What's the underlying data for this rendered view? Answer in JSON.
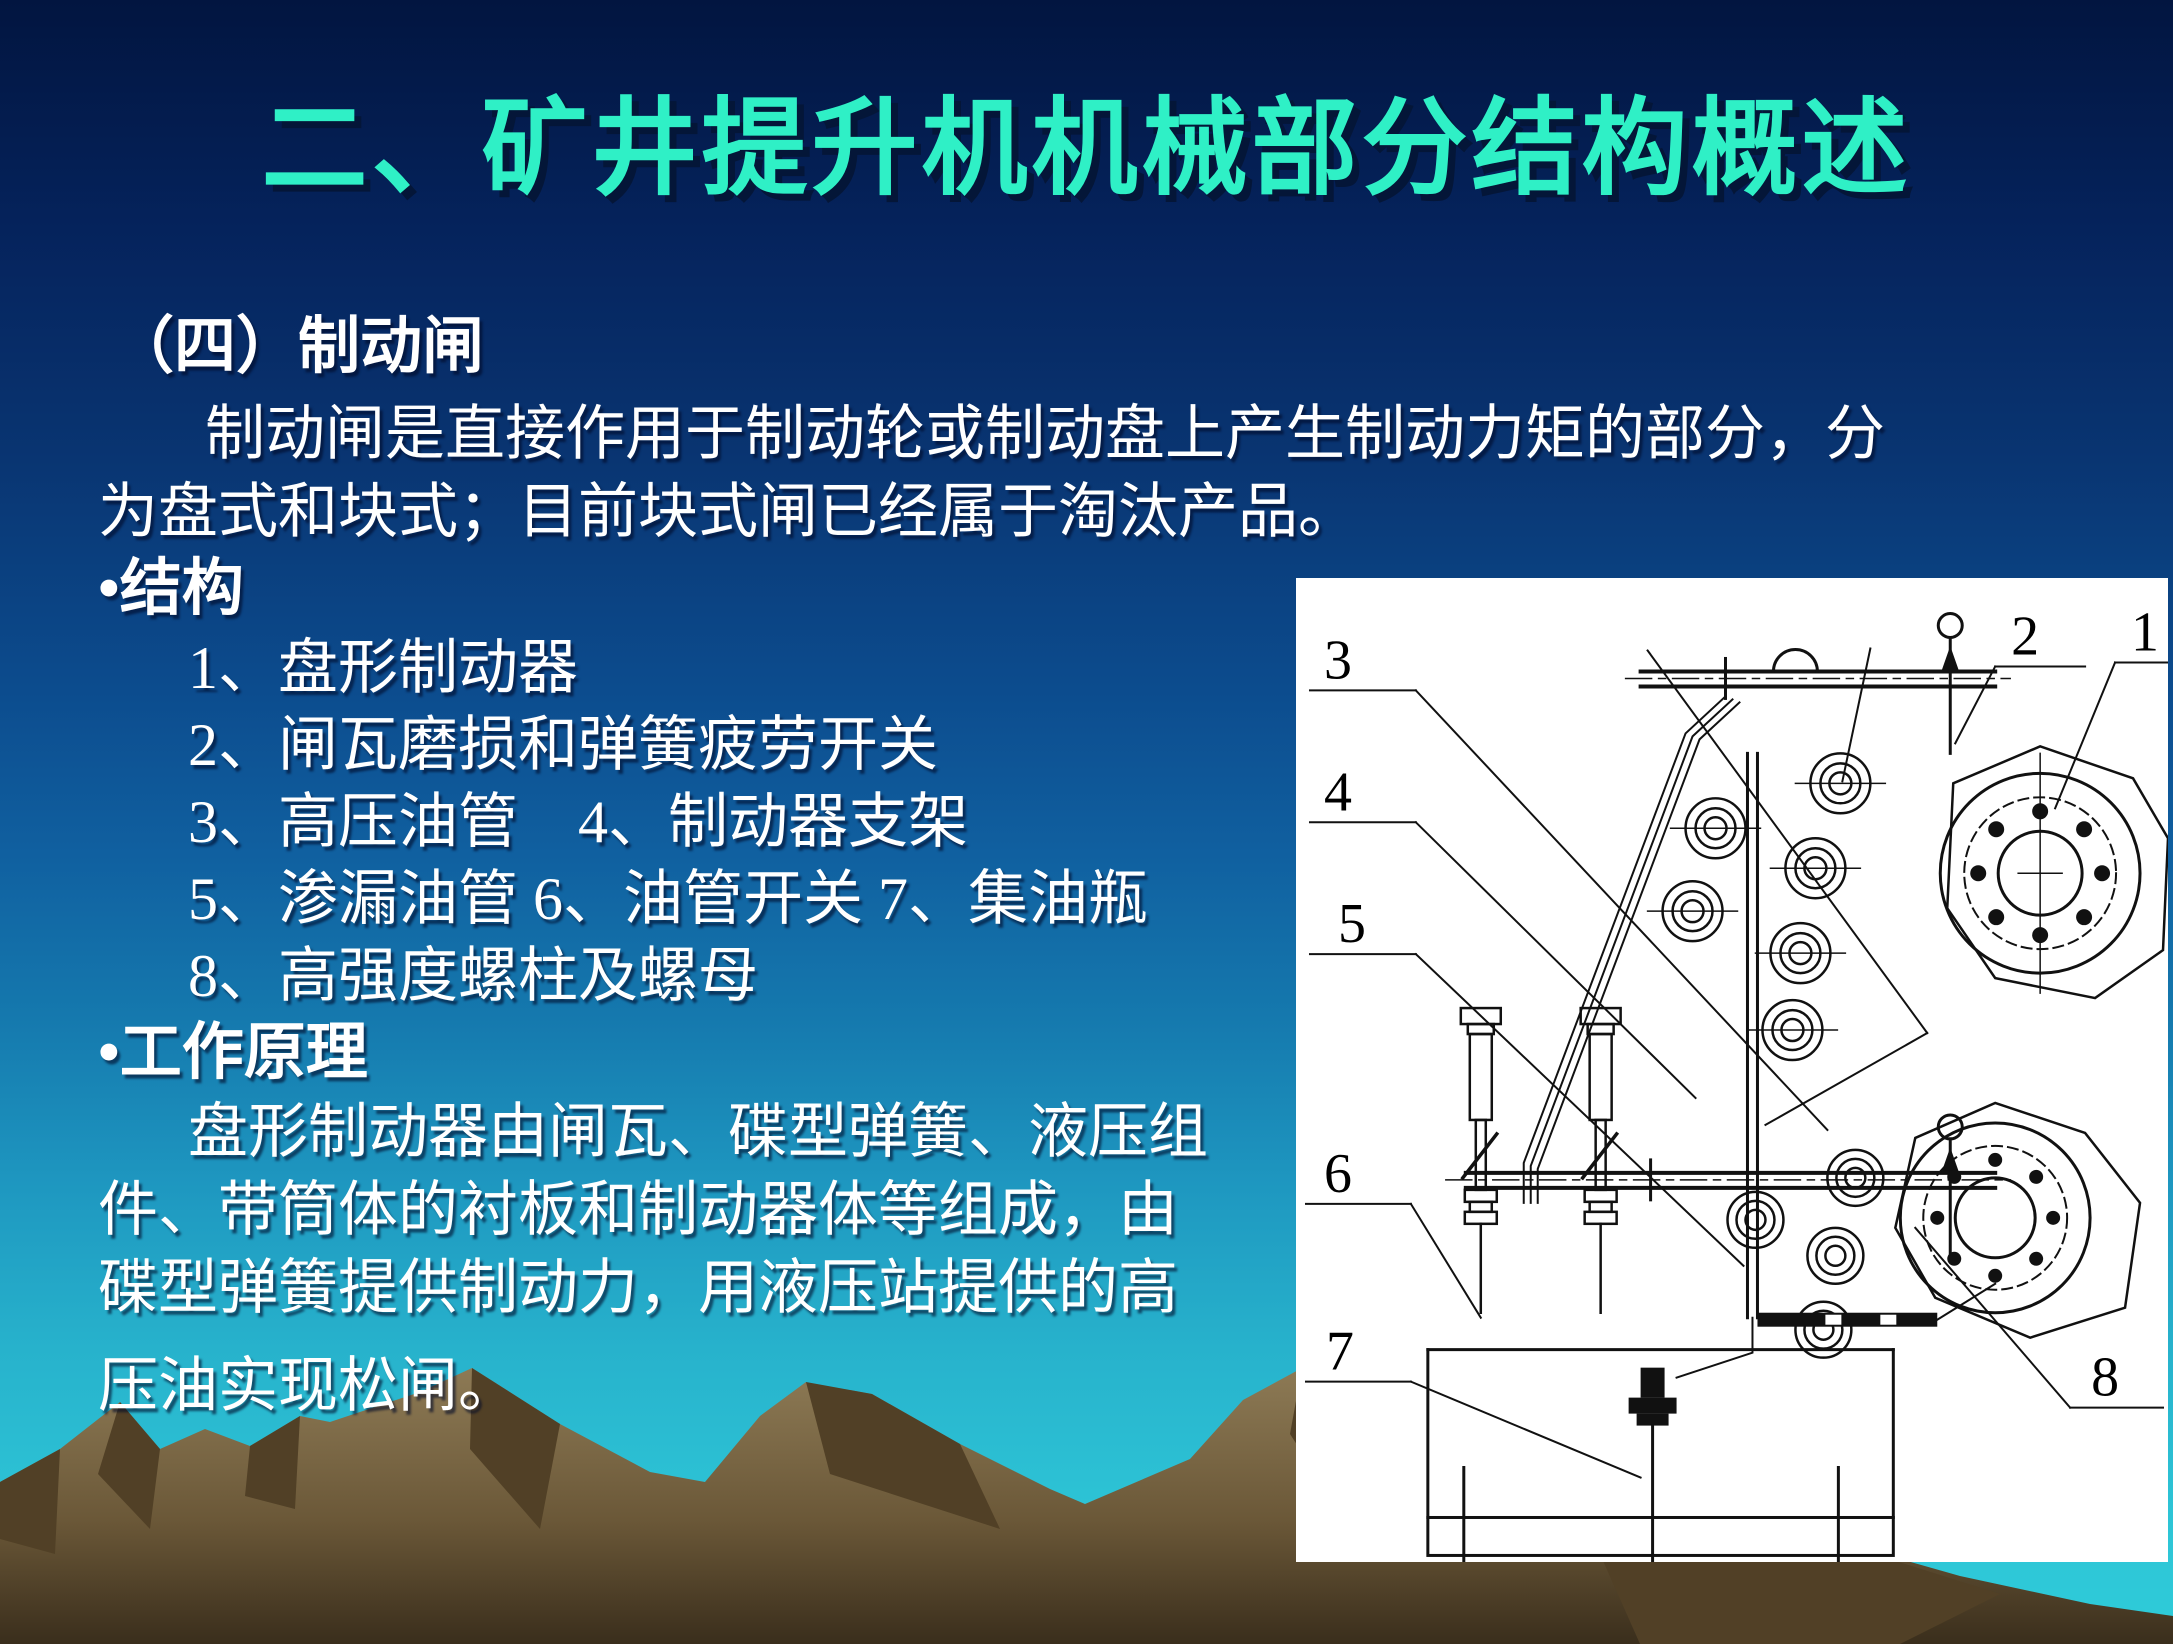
{
  "title": "二、矿井提升机机械部分结构概述",
  "section": {
    "heading": "（四）制动闸"
  },
  "intro": {
    "line1": "制动闸是直接作用于制动轮或制动盘上产生制动力矩的部分，分",
    "line2": "为盘式和块式；目前块式闸已经属于淘汰产品。"
  },
  "structure": {
    "heading": "•结构",
    "items": [
      "1、盘形制动器",
      "2、闸瓦磨损和弹簧疲劳开关",
      "3、高压油管　4、制动器支架",
      "5、渗漏油管 6、油管开关 7、集油瓶",
      "8、高强度螺柱及螺母"
    ]
  },
  "principle": {
    "heading": "•工作原理",
    "lines": [
      "盘形制动器由闸瓦、碟型弹簧、液压组",
      "件、带筒体的衬板和制动器体等组成，由",
      "碟型弹簧提供制动力，用液压站提供的高",
      "压油实现松闸。"
    ]
  },
  "diagram": {
    "labels": [
      "1",
      "2",
      "3",
      "4",
      "5",
      "6",
      "7",
      "8"
    ]
  },
  "colors": {
    "title_text": "#2FF0C6",
    "body_text": "#FFFFFF",
    "background_top": "#021540",
    "background_bottom": "#2FCCD9",
    "mountain_light": "#8A7851",
    "mountain_dark": "#4F3D24",
    "diagram_background": "#FFFFFF",
    "diagram_lines": "#000000"
  }
}
